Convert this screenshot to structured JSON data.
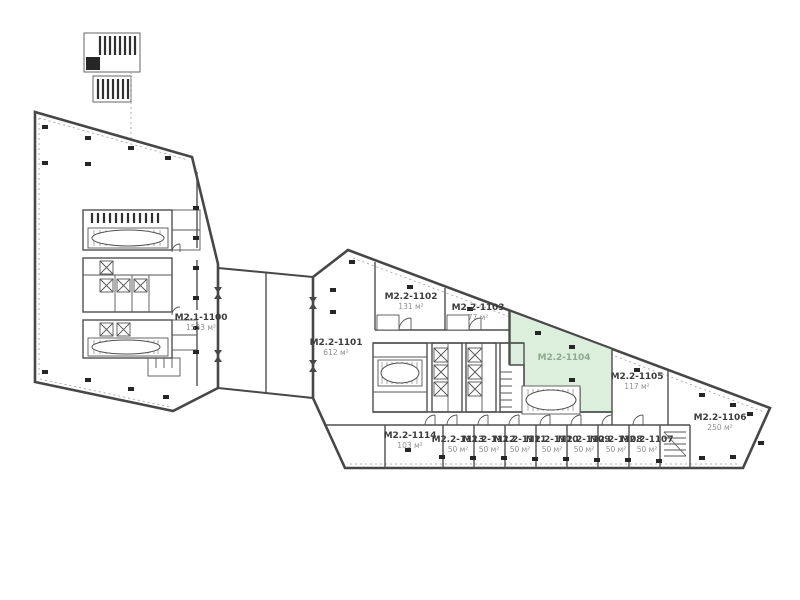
{
  "colors": {
    "highlight_fill": "#dcefdc",
    "highlight_label": "#8fa98f",
    "label_color": "#3d3d3d",
    "area_color": "#8f8f8f",
    "wall_color": "#474747"
  },
  "rooms": [
    {
      "name": "M2.1-1100",
      "area": "1533 м²",
      "highlighted": false
    },
    {
      "name": "M2.2-1101",
      "area": "612 м²",
      "highlighted": false
    },
    {
      "name": "M2.2-1102",
      "area": "131 м²",
      "highlighted": false
    },
    {
      "name": "M2.2-1103",
      "area": "77 м²",
      "highlighted": false
    },
    {
      "name": "M2.2-1104",
      "area": "",
      "highlighted": true
    },
    {
      "name": "M2.2-1105",
      "area": "117 м²",
      "highlighted": false
    },
    {
      "name": "M2.2-1106",
      "area": "250 м²",
      "highlighted": false
    },
    {
      "name": "M2.2-1114",
      "area": "103 м²",
      "highlighted": false
    },
    {
      "name": "M2.2-1113",
      "area": "50 м²",
      "highlighted": false
    },
    {
      "name": "M2.2-1112",
      "area": "50 м²",
      "highlighted": false
    },
    {
      "name": "M2.2-1111",
      "area": "50 м²",
      "highlighted": false
    },
    {
      "name": "M2.2-1110",
      "area": "50 м²",
      "highlighted": false
    },
    {
      "name": "M2.2-1109",
      "area": "50 м²",
      "highlighted": false
    },
    {
      "name": "M2.2-1108",
      "area": "50 м²",
      "highlighted": false
    },
    {
      "name": "M2.2-1107",
      "area": "50 м²",
      "highlighted": false
    }
  ]
}
